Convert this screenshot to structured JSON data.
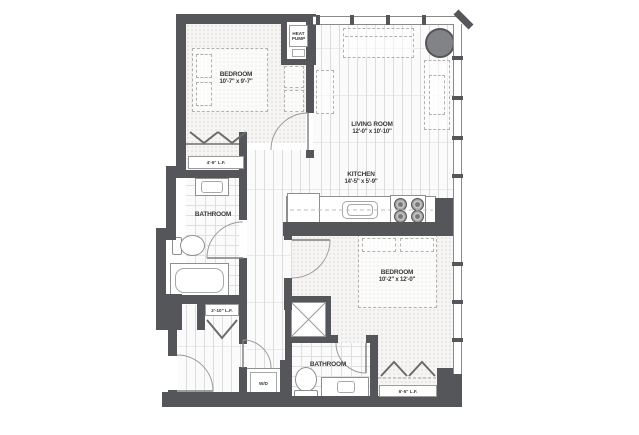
{
  "plan": {
    "type": "apartment-floor-plan",
    "units": "feet-inches"
  },
  "rooms": {
    "bedroom1": {
      "name": "BEDROOM",
      "dims": "10'-7\" x 9'-7\""
    },
    "living_room": {
      "name": "LIVING ROOM",
      "dims": "12'-0\" x 10'-10\""
    },
    "kitchen": {
      "name": "KITCHEN",
      "dims": "14'-5\" x 5'-9\""
    },
    "bathroom1": {
      "name": "BATHROOM"
    },
    "bedroom2": {
      "name": "BEDROOM",
      "dims": "10'-2\" x 12'-0\""
    },
    "bathroom2": {
      "name": "BATHROOM"
    },
    "heat_pump": {
      "name": "HEAT PUMP"
    },
    "laundry": {
      "name": "W/D"
    }
  },
  "closets": {
    "bedroom1_closet": {
      "label": "4'-6\" L.F."
    },
    "entry_closet": {
      "label": "2'-10\" L.F."
    },
    "bedroom2_closet": {
      "label": "6'-5\" L.F."
    }
  },
  "colors": {
    "wall": "#54565a",
    "column_fill": "#818387",
    "fixture_line": "#8f8f8f",
    "furniture_dash": "#b3b2af"
  }
}
